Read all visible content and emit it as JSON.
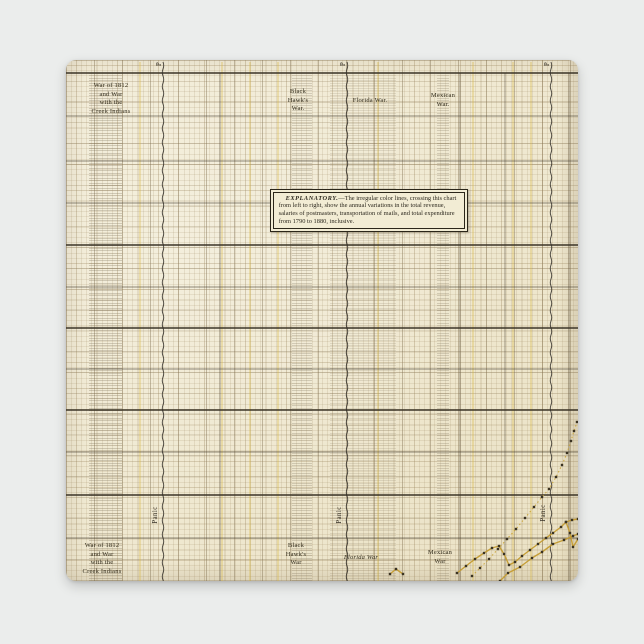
{
  "page": {
    "background_color": "#ebedec",
    "paper_color": "#f0e9d2"
  },
  "labels": {
    "war1812_top": {
      "l1": "War of 1812",
      "l2": "and War",
      "l3": "with the",
      "l4": "Creek Indians"
    },
    "black_hawk_top": {
      "l1": "Black",
      "l2": "Hawk's",
      "l3": "War."
    },
    "florida_top": {
      "l1": "Florida War."
    },
    "mexican_top": {
      "l1": "Mexican",
      "l2": "War."
    },
    "panic_top": {
      "p1": "P",
      "p2": "P",
      "p3": "P"
    },
    "war1812_bottom": {
      "l1": "War of 1812",
      "l2": "and War",
      "l3": "with the",
      "l4": "Creek Indians"
    },
    "black_hawk_bottom": {
      "l1": "Black",
      "l2": "Hawk's",
      "l3": "War"
    },
    "florida_bottom": {
      "l1": "Florida War"
    },
    "mexican_bottom": {
      "l1": "Mexican",
      "l2": "War"
    },
    "panic_bottom": {
      "p1": "Panic",
      "p2": "Panic",
      "p3": "Panic"
    }
  },
  "explanatory": {
    "heading": "EXPLANATORY.",
    "body": "—The irregular color lines, crossing this chart from left to right, show the annual variations in the total revenue, salaries of postmasters, transportation of mails, and total expenditure from 1790 to 1880, inclusive."
  },
  "chart_data": {
    "type": "line",
    "title": "",
    "xlabel": "",
    "ylabel": "",
    "x_range_years": [
      1790,
      1880
    ],
    "axis_tick_labels_visible": false,
    "grid": "on",
    "series_described": [
      "total revenue",
      "salaries of postmasters",
      "transportation of mails",
      "total expenditure"
    ],
    "colors": {
      "line_gold": "#c49b2f",
      "dot": "#3b3322",
      "panic_line": "#34302a",
      "war_band": "#504332"
    },
    "annotations": {
      "wars": [
        {
          "name": "War of 1812 and War with the Creek Indians",
          "band_x": 23,
          "band_width": 33,
          "intensity": 0.52
        },
        {
          "name": "Black Hawk's War",
          "band_x": 226,
          "band_width": 20,
          "intensity": 0.46
        },
        {
          "name": "Florida War",
          "band_x": 264,
          "band_width": 66,
          "intensity": 0.3
        },
        {
          "name": "Mexican War",
          "band_x": 371,
          "band_width": 12,
          "intensity": 0.44
        }
      ],
      "panics": [
        {
          "x": 97
        },
        {
          "x": 281
        },
        {
          "x": 485
        }
      ]
    },
    "layout_hints": {
      "thick_hlines_y": [
        13,
        185,
        268,
        350,
        435
      ],
      "medium_hlines_y": [
        56,
        101,
        143,
        227,
        309,
        392,
        478
      ],
      "dark_vlines_x": [
        154,
        394,
        439,
        503
      ],
      "accent_vlines_x": [
        74,
        156,
        184,
        212,
        312,
        407,
        447,
        465
      ]
    },
    "traced_lines_px": [
      {
        "name": "expenditure-dotted-line",
        "style": "dotted",
        "points": [
          [
            406,
            516
          ],
          [
            414,
            508
          ],
          [
            423,
            499
          ],
          [
            432,
            489
          ],
          [
            441,
            479
          ],
          [
            450,
            469
          ],
          [
            459,
            458
          ],
          [
            468,
            447
          ],
          [
            476,
            437
          ],
          [
            483,
            429
          ],
          [
            490,
            417
          ],
          [
            496,
            405
          ],
          [
            501,
            393
          ],
          [
            505,
            381
          ],
          [
            508,
            371
          ],
          [
            511,
            362
          ]
        ]
      },
      {
        "name": "gold-line-upper",
        "style": "solid",
        "points": [
          [
            391,
            513
          ],
          [
            400,
            506
          ],
          [
            409,
            499
          ],
          [
            418,
            493
          ],
          [
            426,
            488
          ],
          [
            433,
            486
          ],
          [
            438,
            494
          ],
          [
            443,
            505
          ],
          [
            449,
            502
          ],
          [
            456,
            496
          ],
          [
            464,
            490
          ],
          [
            472,
            484
          ],
          [
            480,
            478
          ],
          [
            487,
            473
          ],
          [
            495,
            467
          ],
          [
            500,
            462
          ],
          [
            506,
            460
          ],
          [
            512,
            459
          ]
        ]
      },
      {
        "name": "gold-line-fork",
        "style": "solid",
        "points": [
          [
            500,
            462
          ],
          [
            504,
            473
          ],
          [
            507,
            487
          ],
          [
            512,
            479
          ]
        ]
      },
      {
        "name": "gold-line-lower",
        "style": "solid",
        "points": [
          [
            434,
            521
          ],
          [
            442,
            513
          ],
          [
            454,
            507
          ],
          [
            466,
            498
          ],
          [
            476,
            492
          ],
          [
            487,
            484
          ],
          [
            498,
            480
          ],
          [
            507,
            476
          ],
          [
            512,
            474
          ]
        ]
      },
      {
        "name": "gold-line-fragment",
        "style": "solid",
        "points": [
          [
            324,
            514
          ],
          [
            330,
            509
          ],
          [
            337,
            514
          ]
        ]
      }
    ]
  }
}
